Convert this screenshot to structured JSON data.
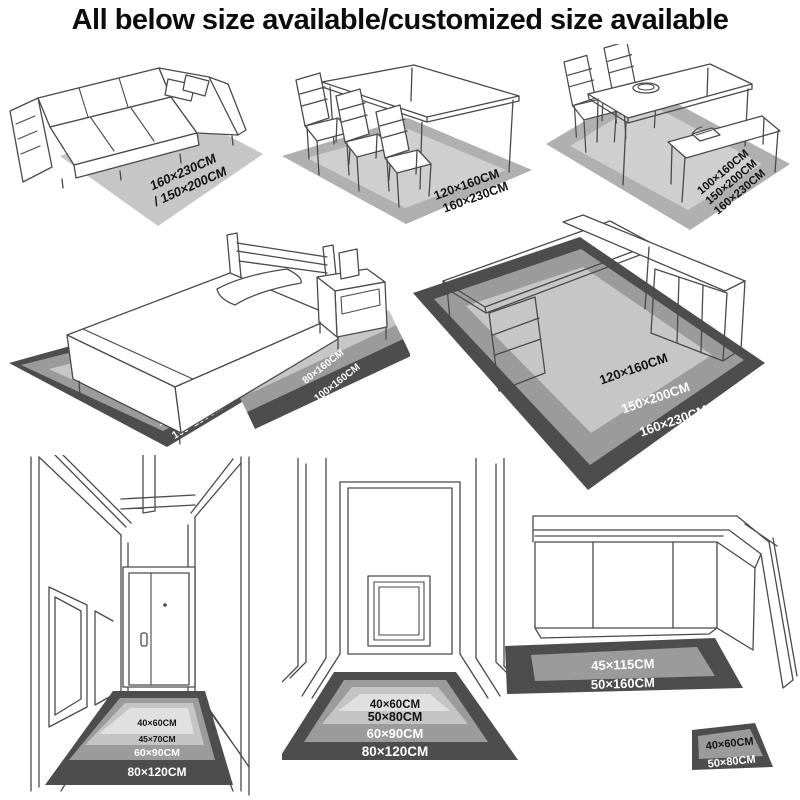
{
  "title": "All below size available/customized size available",
  "colors": {
    "page_bg": "#ffffff",
    "title_color": "#0d0d0d",
    "line_art": "#4a4a4a",
    "rug_light": "#c6c6c6",
    "rug_inner": "#cfcfcf",
    "rug_border": "#b0b0b0",
    "rug_pale": "#e0e0e0",
    "rug_pale2": "#c4c4c4",
    "rug_medium": "#9b9b9b",
    "rug_dark": "#4d4d4d",
    "label_dark": "#141414",
    "label_light": "#ffffff"
  },
  "scenes": {
    "sofa_rug": {
      "labels": [
        "160×230CM",
        "/ 150×200CM"
      ]
    },
    "dining_rug": {
      "labels": [
        "120×160CM",
        "160×230CM"
      ]
    },
    "dining_bench_rug": {
      "labels": [
        "100×160CM",
        "150×200CM",
        "160×230CM"
      ]
    },
    "bed_area_rug": {
      "labels": [
        "80×160CM",
        "150×200CM",
        "160×230CM"
      ]
    },
    "bed_runner_rug": {
      "labels": [
        "50×160CM",
        "80×160CM",
        "100×160CM"
      ]
    },
    "desk_rug": {
      "labels": [
        "120×160CM",
        "150×200CM",
        "160×230CM"
      ]
    },
    "hallway_rug": {
      "labels": [
        "40×60CM",
        "45×70CM",
        "60×90CM",
        "80×120CM"
      ]
    },
    "corridor_rug": {
      "labels": [
        "40×60CM",
        "50×80CM",
        "60×90CM",
        "80×120CM"
      ]
    },
    "kitchen_runner_rug": {
      "labels": [
        "45×115CM",
        "50×160CM"
      ]
    },
    "kitchen_mat_rug": {
      "labels": [
        "40×60CM",
        "50×80CM"
      ]
    }
  }
}
